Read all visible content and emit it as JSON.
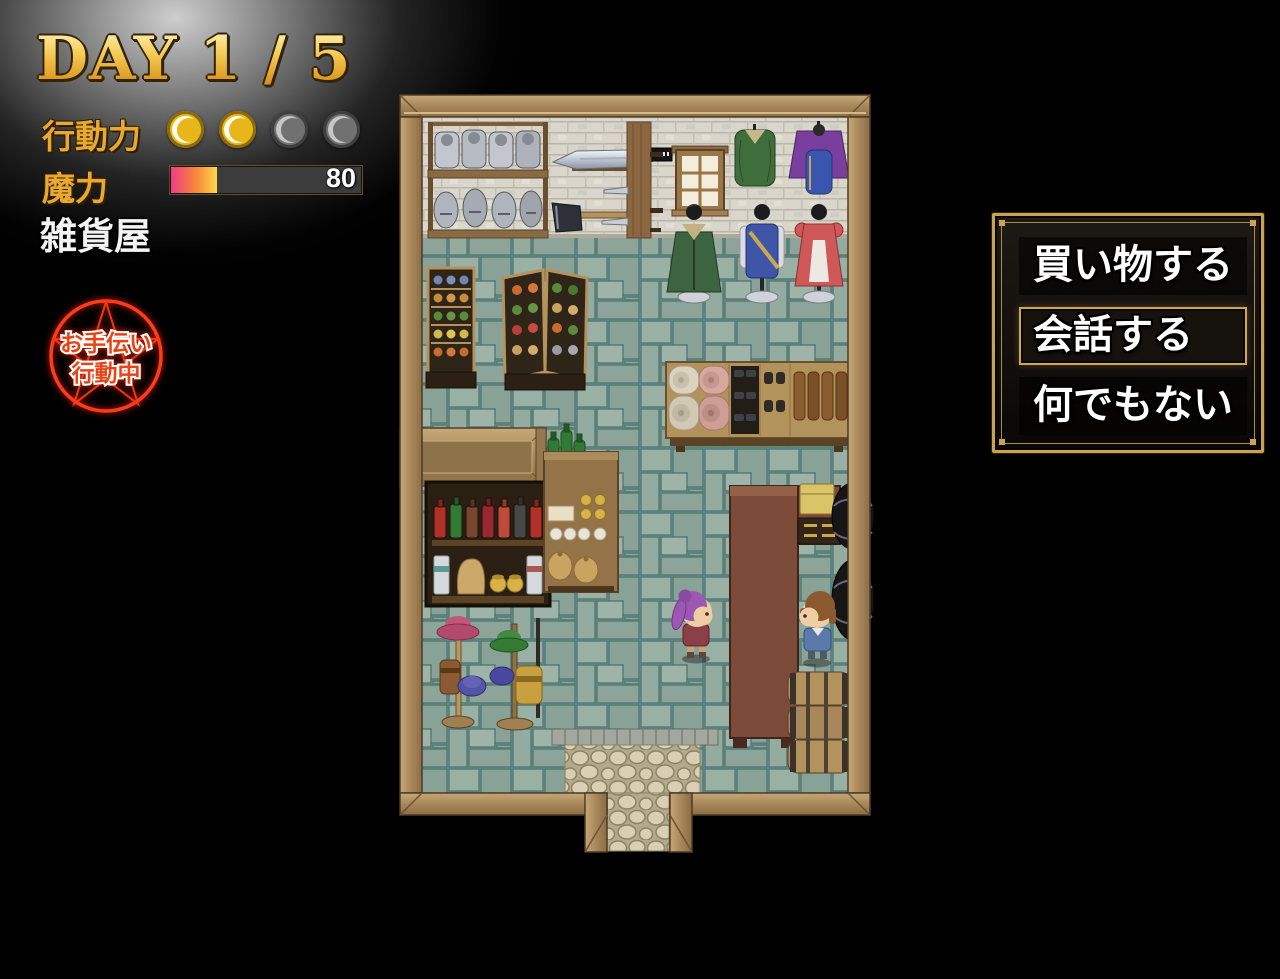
{
  "colors": {
    "accent_gold": "#c9a253",
    "hud_gold": "#eaa92e",
    "badge_red": "#ff3a1a",
    "wood_frame": "#a8875a",
    "floor_tile": "#8fa89d",
    "wall_brick": "#d9d6cc",
    "counter_wood": "#7c4a38"
  },
  "hud": {
    "day_label": "DAY 1 / 5",
    "action": {
      "label": "行動力",
      "filled": 2,
      "total": 4
    },
    "magic": {
      "label": "魔力",
      "value": "80",
      "percent": 24
    },
    "location": "雑貨屋",
    "badge": {
      "line1": "お手伝い",
      "line2": "行動中"
    }
  },
  "menu": {
    "items": [
      {
        "label": "買い物する",
        "selected": false
      },
      {
        "label": "会話する",
        "selected": true
      },
      {
        "label": "何でもない",
        "selected": false
      }
    ],
    "selected_index": 1
  },
  "map": {
    "location_name": "雑貨屋",
    "objects": [
      "armor-shelf",
      "sword-display",
      "axe-display",
      "dagger-rack",
      "window",
      "hanging-tunic-green",
      "hanging-outfit-purple",
      "mannequin-green-cloak",
      "mannequin-blue-uniform",
      "mannequin-red-dress",
      "produce-stand-left",
      "produce-stand-center",
      "goods-shelf",
      "partition-wall",
      "potion-shelf",
      "goods-table",
      "hat-stand-1",
      "hat-stand-2",
      "shop-counter",
      "cash-box",
      "storage-jars",
      "barrel-stack",
      "doorway-threshold",
      "entrance-path"
    ],
    "characters": [
      {
        "name": "player",
        "hair": "purple"
      },
      {
        "name": "shopkeeper",
        "hair": "brown"
      }
    ]
  }
}
